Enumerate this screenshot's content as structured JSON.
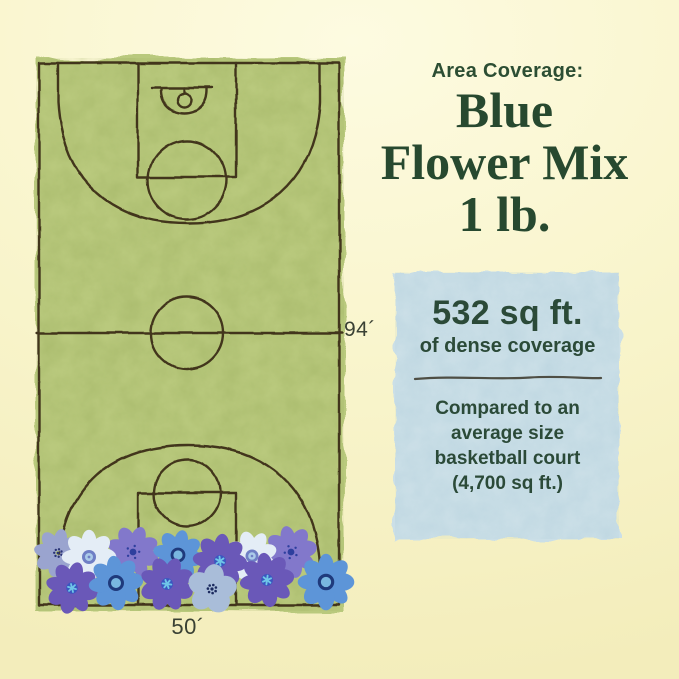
{
  "header": {
    "kicker": "Area Coverage:",
    "title_line1": "Blue",
    "title_line2": "Flower Mix",
    "title_line3": "1 lb."
  },
  "court": {
    "length_label": "94´",
    "width_label": "50´"
  },
  "info_box": {
    "stat_value": "532 sq ft.",
    "stat_caption": "of dense coverage",
    "comparison_line1": "Compared to an",
    "comparison_line2": "average size",
    "comparison_line3": "basketball court",
    "comparison_line4": "(4,700 sq ft.)"
  },
  "colors": {
    "background": "#f8f4ca",
    "court_green": "#b9c97d",
    "court_ink": "#42361c",
    "heading_green": "#27492f",
    "dimension_text": "#3a4134",
    "info_box_blue": "#cbdfe7",
    "divider_gray": "#4e4e44",
    "flower_pale": "#e4edf6",
    "flower_periwinkle": "#8278cb",
    "flower_purple": "#6a58b8",
    "flower_blue": "#5d95d8",
    "flower_gray_blue": "#a9bdd9"
  }
}
